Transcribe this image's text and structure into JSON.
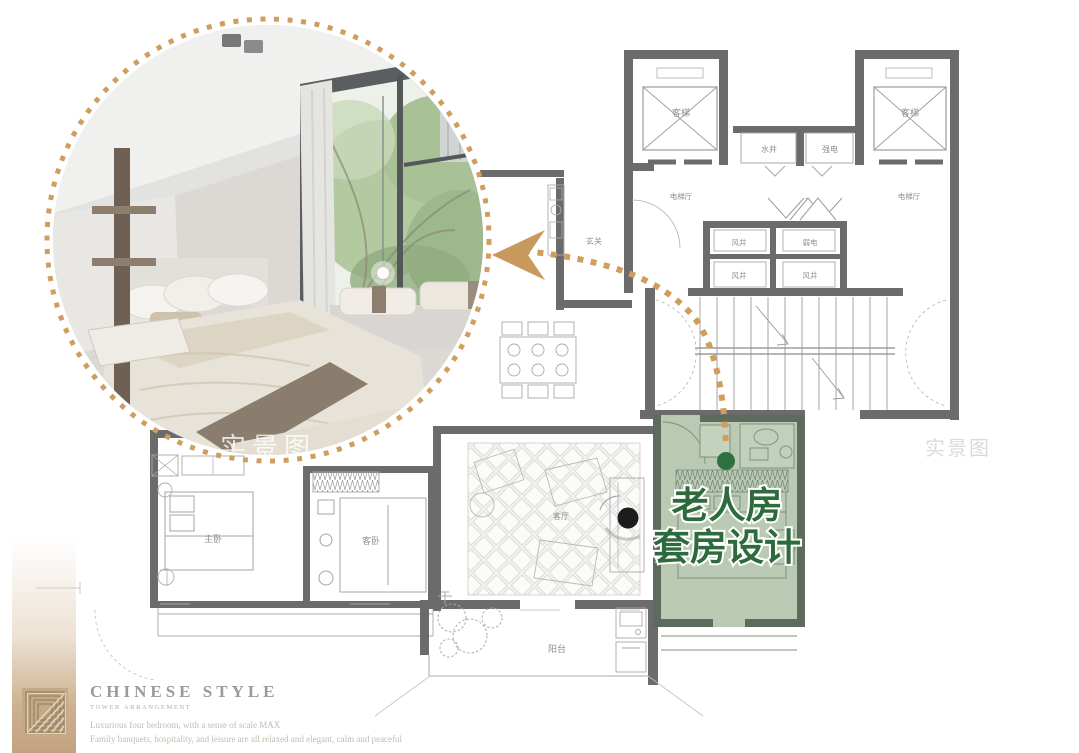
{
  "photo": {
    "watermark": "实景图"
  },
  "plan": {
    "watermark_right": "实景图",
    "labels": {
      "elevator_left": "客梯",
      "elevator_right": "客梯",
      "water_shaft": "水井",
      "strong_electric": "强电",
      "elevator_hall_left": "电梯厅",
      "elevator_hall_right": "电梯厅",
      "air_shaft_1": "风井",
      "weak_electric": "弱电",
      "air_shaft_2": "风井",
      "air_shaft_3": "风井",
      "entry": "玄关",
      "master_bedroom": "主卧",
      "guest_bedroom": "客卧",
      "living_room": "客厅",
      "balcony": "阳台"
    }
  },
  "highlight": {
    "title_line1": "老人房",
    "title_line2": "套房设计",
    "text_color": "#2d6b3c",
    "room_fill": "#b9c9b2",
    "trail_color": "#cf9e5f"
  },
  "footer": {
    "logo_icon": "geometric-square-logo",
    "title": "CHINESE STYLE",
    "subtitle": "TOWER ARRANGEMENT",
    "tagline1": "Luxurious four bedroom, with a sense of scale MAX",
    "tagline2": "Family banquets, hospitality, and leisure are all relaxed and elegant, calm and peaceful"
  }
}
